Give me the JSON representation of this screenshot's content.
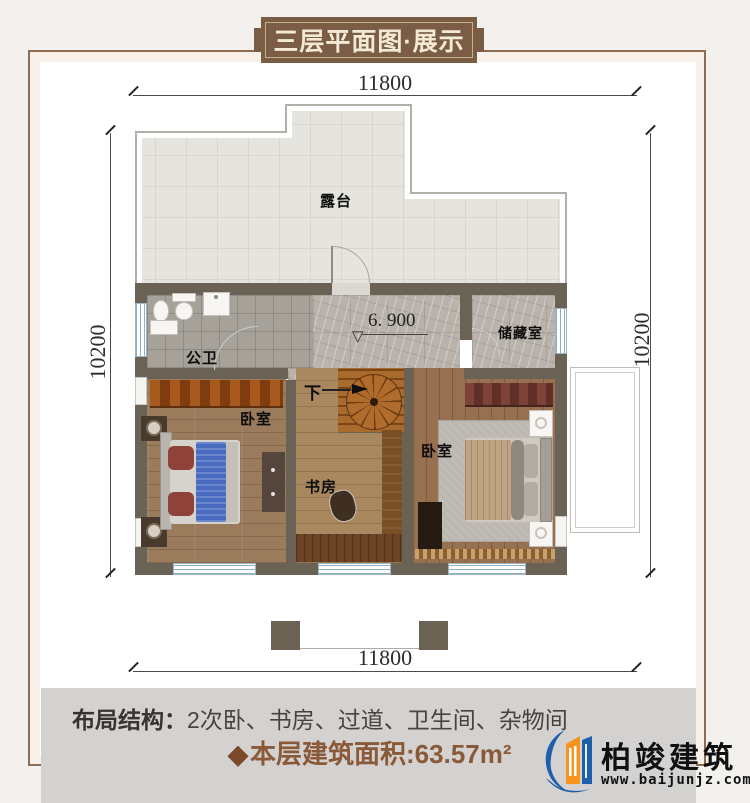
{
  "banner": {
    "title": "三层平面图·展示"
  },
  "dimensions": {
    "top": "11800",
    "bottom": "11800",
    "left": "10200",
    "right": "10200"
  },
  "plan": {
    "elevation": "6. 900",
    "elevation_symbol": "▽",
    "rooms": {
      "terrace": "露台",
      "bathroom": "公卫",
      "storage": "储藏室",
      "bedroom_left": "卧室",
      "study": "书房",
      "bedroom_right": "卧室",
      "stairs_down": "下"
    }
  },
  "footer": {
    "layout_label": "布局结构：",
    "layout_value": "2次卧、书房、过道、卫生间、杂物间",
    "area_diamond": "◆",
    "area_label": "本层建筑面积:",
    "area_value": "63.57m²"
  },
  "logo": {
    "name": "柏竣建筑",
    "url": "www.baijunjz.com"
  },
  "colors": {
    "accent_brown": "#7b5c45",
    "wall": "#6a6355",
    "area_text": "#8a5a38",
    "logo_blue": "#1d5fa8",
    "logo_orange": "#f7941d"
  }
}
